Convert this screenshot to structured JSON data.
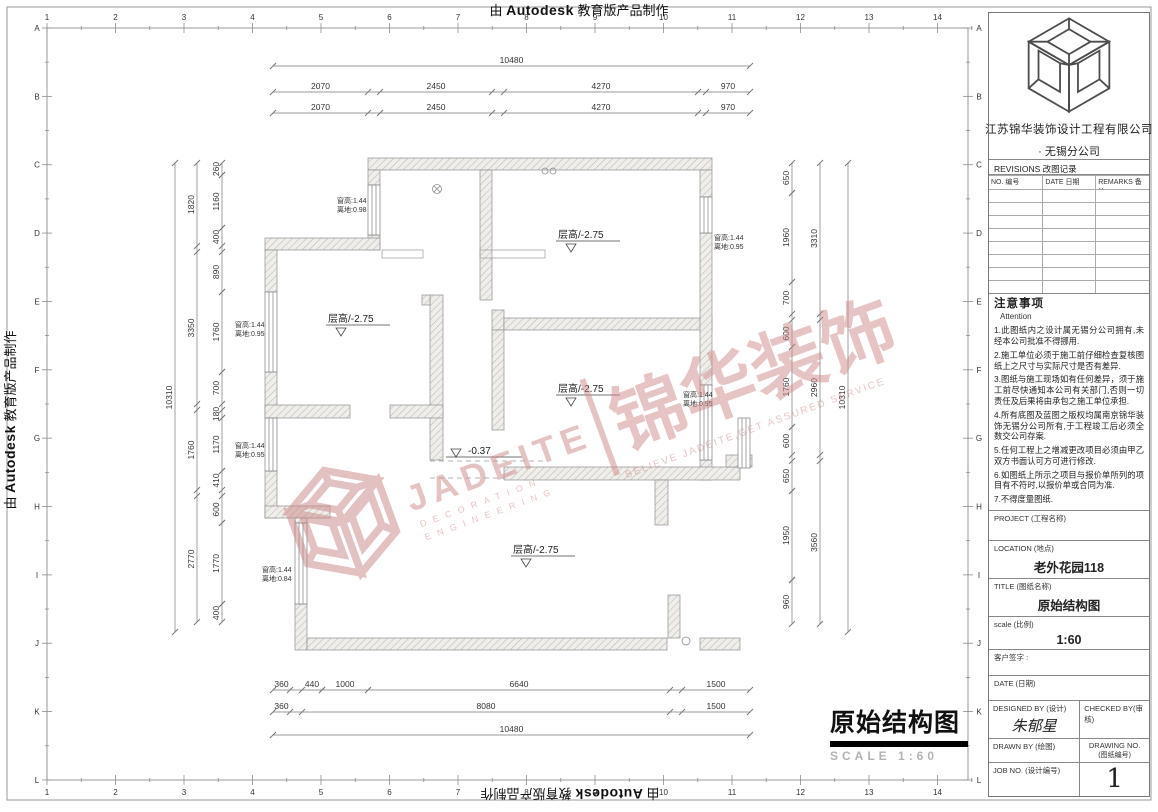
{
  "edge": {
    "prefix": "由",
    "brand": "Autodesk",
    "suffix": "教育版产品制作"
  },
  "ruler": {
    "cols": [
      "1",
      "2",
      "3",
      "4",
      "5",
      "6",
      "7",
      "8",
      "9",
      "10",
      "11",
      "12",
      "13",
      "14"
    ],
    "rows": [
      "A",
      "B",
      "C",
      "D",
      "E",
      "F",
      "G",
      "H",
      "I",
      "J",
      "K",
      "L"
    ]
  },
  "plan": {
    "room_label": "层高/-2.75",
    "level_mark": "-0.37",
    "window_labels": [
      {
        "line1": "窗高:1.44",
        "line2": "离地:0.98"
      },
      {
        "line1": "窗高:1.44",
        "line2": "离地:0.95"
      },
      {
        "line1": "窗高:1.44",
        "line2": "离地:0.95"
      },
      {
        "line1": "窗高:1.44",
        "line2": "离地:0.84"
      },
      {
        "line1": "窗高:1.44",
        "line2": "离地:0.95"
      },
      {
        "line1": "窗高:1.44",
        "line2": "离地:0.95"
      }
    ],
    "dims": {
      "top": {
        "total": "10480",
        "row": [
          "2070",
          "2450",
          "4270",
          "970"
        ]
      },
      "bottom": {
        "row1": [
          "360",
          "440",
          "1000",
          "6640",
          "1500"
        ],
        "row2": [
          "360",
          "8080",
          "1500"
        ],
        "total": "10480"
      },
      "left": {
        "total": "10310",
        "mid": [
          "1820",
          "3350",
          "1760",
          "2770"
        ],
        "inner": [
          "260",
          "1160",
          "400",
          "890",
          "1760",
          "700",
          "180",
          "1170",
          "410",
          "600",
          "1770",
          "400"
        ]
      },
      "right": {
        "inner": [
          "650",
          "1960",
          "700",
          "600",
          "1760",
          "600",
          "650",
          "1950",
          "960"
        ],
        "mid": [
          "3310",
          "2960",
          "3560"
        ],
        "total": "10310"
      }
    }
  },
  "watermark": {
    "brand_en": "JADEITE",
    "sub1": "DECORATION",
    "sub2": "ENGINEERING",
    "brand_cn": "锦华装饰",
    "slogan": "BELIEVE JADEITE,GET ASSURED SERVICE",
    "color": "#d18b8b"
  },
  "draw_title": {
    "text": "原始结构图",
    "scale_word": "SCALE",
    "scale_ratio": "1:60"
  },
  "title_block": {
    "company_line1": "江苏锦华装饰设计工程有限公司",
    "company_line2": "·  无锡分公司",
    "revisions_title": "REVISIONS 改图记录",
    "rev_cols": [
      "NO. 编号",
      "DATE 日期",
      "REMARKS 备注"
    ],
    "rev_empty_rows": 8,
    "notes_title": "注意事项",
    "notes_sub": "Attention",
    "notes": [
      "1.此图纸内之设计属无锡分公司拥有,未经本公司批准不得挪用.",
      "2.施工单位必须于施工前仔细检查复核图纸上之尺寸与实际尺寸是否有差异.",
      "3.图纸与施工现场如有任何差异，须于施工前尽快通知本公司有关部门,否则一切责任及后果将由承包之施工单位承担.",
      "4.所有底图及蓝图之版权均属南京锦华装饰无锡分公司所有,于工程竣工后必须全数交公司存案.",
      "5.任何工程上之增减更改项目必须由甲乙双方书面认可方可进行修改.",
      "6.如图纸上所示之项目与报价单所列的项目有不符时,以报价单或合同为准.",
      "7.不得度量图纸."
    ],
    "project_label": "PROJECT (工程名称)",
    "location_label": "LOCATION (地点)",
    "location_value": "老外花园118",
    "title_label": "TITLE (图纸名称)",
    "title_value": "原始结构图",
    "scale_label": "scale (比例)",
    "scale_value": "1:60",
    "client_sign_label": "客户签字 :",
    "date_label": "DATE (日期)",
    "designed_by_label": "DESIGNED BY (设计)",
    "designer_signature": "朱郁星",
    "checked_by_label": "CHECKED BY(审核)",
    "drawn_by_label": "DRAWN BY (绘图)",
    "drawing_no_label": "DRAWING NO.",
    "drawing_no_sub": "(图纸编号)",
    "drawing_no_value": "1",
    "job_no_label": "JOB NO. (设计编号)"
  }
}
